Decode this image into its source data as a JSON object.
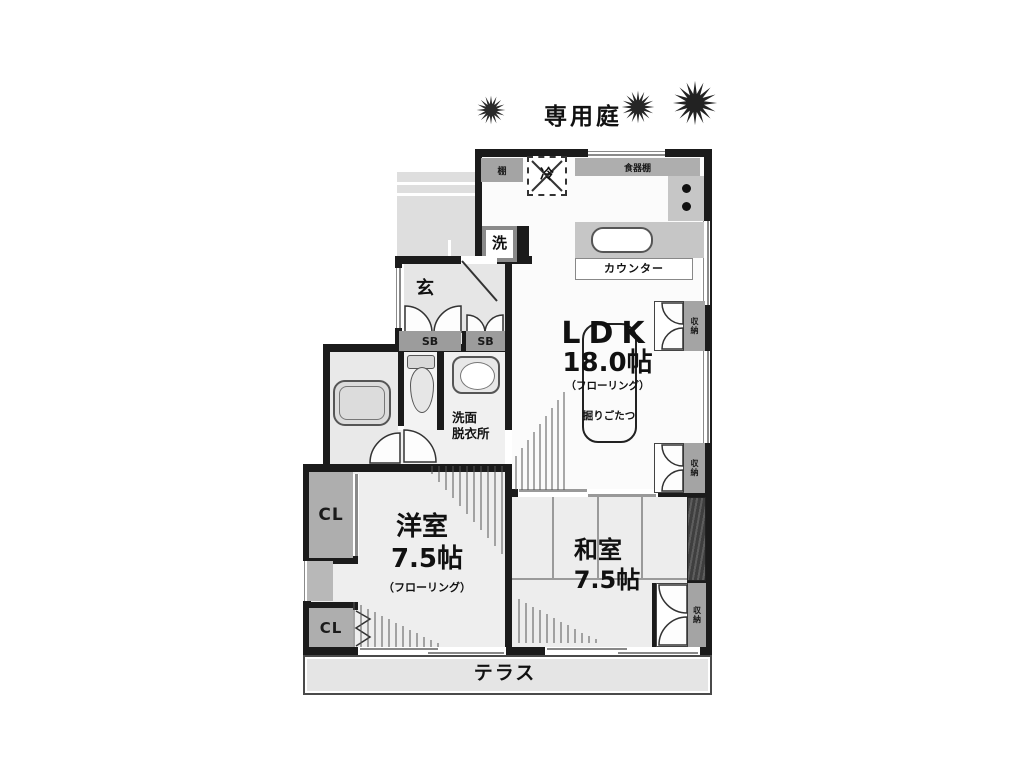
{
  "garden": {
    "label": "専用庭"
  },
  "rooms": {
    "ldk": {
      "name": "LDK",
      "size": "18.0帖",
      "flooring": "（フローリング）",
      "kotatsu": "掘りごたつ"
    },
    "youshitsu": {
      "name": "洋室",
      "size": "7.5帖",
      "flooring": "（フローリング）"
    },
    "washitsu": {
      "name": "和室",
      "size": "7.5帖"
    },
    "genkan": {
      "label": "玄"
    },
    "washroom": {
      "line1": "洗面",
      "line2": "脱衣所"
    },
    "terrace": {
      "label": "テラス"
    }
  },
  "fixtures": {
    "refrigerator": "冷",
    "washer": "洗",
    "shelf": "棚",
    "cupboard": "食器棚",
    "counter": "カウンター",
    "shoebox_left": "SB",
    "shoebox_right": "SB",
    "closet_upper": "CL",
    "closet_lower": "CL",
    "storage_top": "収納",
    "storage_mid": "収納",
    "storage_washitsu": "収納"
  },
  "colors": {
    "wall": "#1b1b1b",
    "fixture_gray": "#a4a4a4",
    "floor_light": "#ededed",
    "wood_dark": "#3f3f3f"
  }
}
